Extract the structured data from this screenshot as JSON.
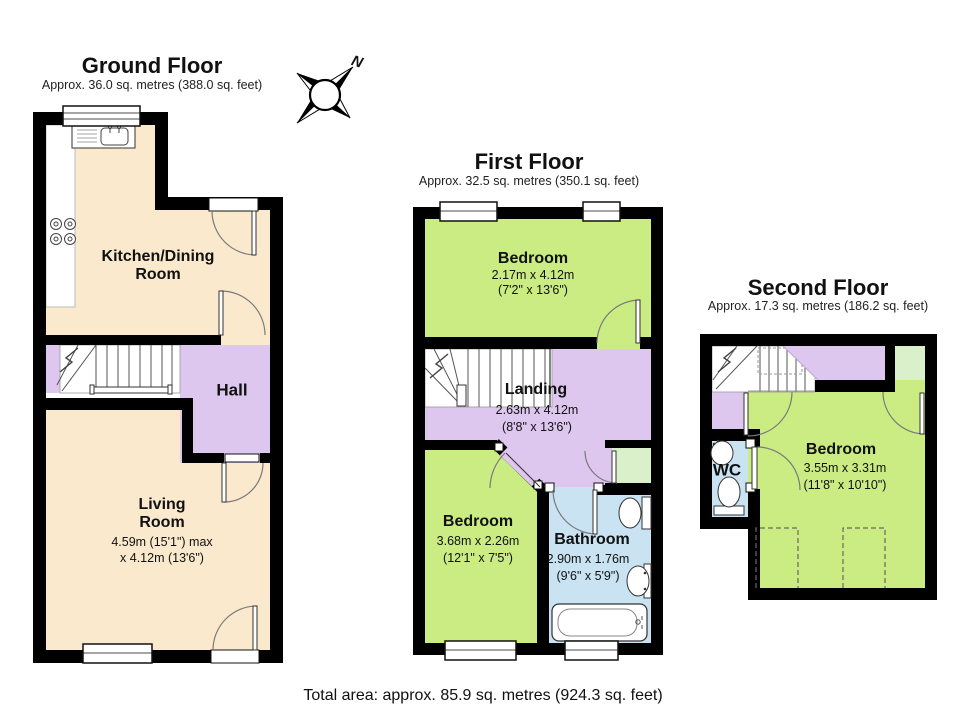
{
  "summary": {
    "total_area": "Total area: approx. 85.9 sq. metres (924.3 sq. feet)"
  },
  "compass": {
    "north_label": "N"
  },
  "colors": {
    "wall": "#000000",
    "room_beige": "#FAE9CD",
    "room_purple": "#DDC7EF",
    "room_green": "#CBEC83",
    "room_pale_green": "#D9F0CB",
    "room_blue": "#C9E3F2"
  },
  "floors": [
    {
      "id": "ground-floor",
      "title": "Ground Floor",
      "area": "Approx. 36.0 sq. metres (388.0 sq. feet)",
      "rooms": [
        {
          "name_line1": "Kitchen/Dining",
          "name_line2": "Room"
        },
        {
          "name_line1": "Hall"
        },
        {
          "name_line1": "Living",
          "name_line2": "Room",
          "dim_metric": "4.59m (15'1\") max",
          "dim_imperial": "x 4.12m (13'6\")"
        }
      ]
    },
    {
      "id": "first-floor",
      "title": "First Floor",
      "area": "Approx. 32.5 sq. metres (350.1 sq. feet)",
      "rooms": [
        {
          "name_line1": "Bedroom",
          "dim_metric": "2.17m x 4.12m",
          "dim_imperial": "(7'2\" x 13'6\")"
        },
        {
          "name_line1": "Landing",
          "dim_metric": "2.63m x 4.12m",
          "dim_imperial": "(8'8\" x 13'6\")"
        },
        {
          "name_line1": "Bedroom",
          "dim_metric": "3.68m x 2.26m",
          "dim_imperial": "(12'1\" x 7'5\")"
        },
        {
          "name_line1": "Bathroom",
          "dim_metric": "2.90m x 1.76m",
          "dim_imperial": "(9'6\" x 5'9\")"
        }
      ]
    },
    {
      "id": "second-floor",
      "title": "Second Floor",
      "area": "Approx. 17.3 sq. metres (186.2 sq. feet)",
      "rooms": [
        {
          "name_line1": "WC"
        },
        {
          "name_line1": "Bedroom",
          "dim_metric": "3.55m x 3.31m",
          "dim_imperial": "(11'8\" x 10'10\")"
        }
      ]
    }
  ]
}
